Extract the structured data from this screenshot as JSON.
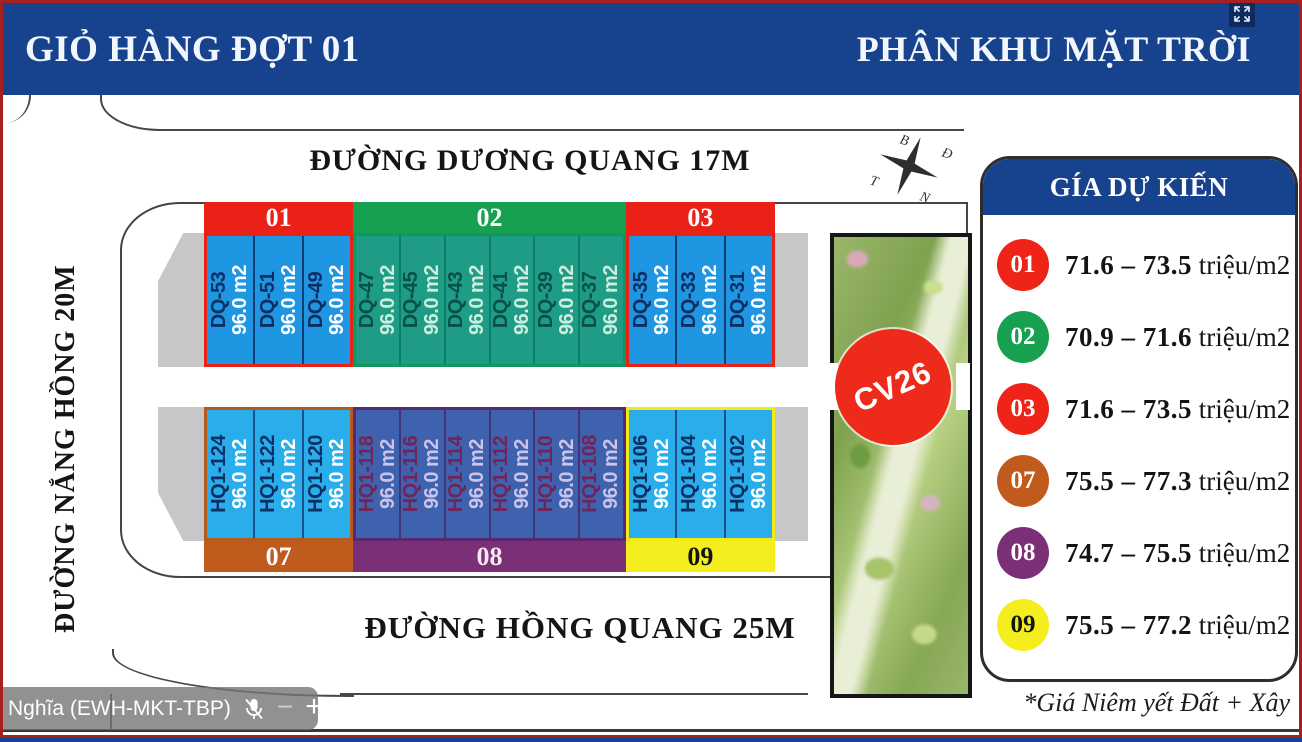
{
  "banner": {
    "left_title": "GIỎ HÀNG ĐỢT 01",
    "right_title": "PHÂN KHU MẶT TRỜI",
    "bg_color": "#17428e"
  },
  "streets": {
    "top": "ĐƯỜNG DƯƠNG QUANG 17M",
    "left": "ĐƯỜNG NẮNG HỒNG 20M",
    "bottom": "ĐƯỜNG HỒNG QUANG 25M"
  },
  "compass": {
    "north": "B",
    "east": "Đ",
    "south": "N",
    "west": "T"
  },
  "park": {
    "label": "CV26",
    "circle_color": "#ee2a1b"
  },
  "area_label": "96.0 m2",
  "blocks": [
    {
      "id": "01",
      "row": "top",
      "header_bg": "#e92117",
      "header_text": "#ffffff",
      "border": "#e92117",
      "plot_bg": "#1e96e2",
      "divider": "#123c74",
      "name_color": "#0d2f63",
      "area_color": "#ffffff",
      "plots": [
        "DQ-53",
        "DQ-51",
        "DQ-49"
      ]
    },
    {
      "id": "02",
      "row": "top",
      "header_bg": "#16a04f",
      "header_text": "#ffffff",
      "border": "#11975c",
      "plot_bg": "#1f9c85",
      "divider": "#0a7f66",
      "name_color": "#07514a",
      "area_color": "#cdeedd",
      "plots": [
        "DQ-47",
        "DQ-45",
        "DQ-43",
        "DQ-41",
        "DQ-39",
        "DQ-37"
      ]
    },
    {
      "id": "03",
      "row": "top",
      "header_bg": "#e92117",
      "header_text": "#ffffff",
      "border": "#e92117",
      "plot_bg": "#1e96e2",
      "divider": "#123c74",
      "name_color": "#0d2f63",
      "area_color": "#ffffff",
      "plots": [
        "DQ-35",
        "DQ-33",
        "DQ-31"
      ]
    },
    {
      "id": "07",
      "row": "bottom",
      "header_bg": "#c05a1d",
      "header_text": "#ffffff",
      "border": "#b55a1d",
      "plot_bg": "#29aeeb",
      "divider": "#1d4f8c",
      "name_color": "#0d2f63",
      "area_color": "#ffffff",
      "plots": [
        "HQ1-124",
        "HQ1-122",
        "HQ1-120"
      ]
    },
    {
      "id": "08",
      "row": "bottom",
      "header_bg": "#7b2f77",
      "header_text": "#f3e8f5",
      "border": "#5d2670",
      "plot_bg": "#3f62ae",
      "divider": "#443277",
      "name_color": "#702457",
      "area_color": "#cdc3ea",
      "plots": [
        "HQ1-118",
        "HQ1-116",
        "HQ1-114",
        "HQ1-112",
        "HQ1-110",
        "HQ1-108"
      ]
    },
    {
      "id": "09",
      "row": "bottom",
      "header_bg": "#f5ee1e",
      "header_text": "#141414",
      "border": "#f2ea16",
      "plot_bg": "#29aeeb",
      "divider": "#1d4f8c",
      "name_color": "#0d2f63",
      "area_color": "#ffffff",
      "plots": [
        "HQ1-106",
        "HQ1-104",
        "HQ1-102"
      ]
    }
  ],
  "legend": {
    "title": "GÍA DỰ KIẾN",
    "header_bg": "#17428e",
    "rows": [
      {
        "id": "01",
        "color": "#ee2418",
        "label_color": "#ffffff",
        "range": "71.6 – 73.5",
        "unit": "triệu/m2"
      },
      {
        "id": "02",
        "color": "#16a04f",
        "label_color": "#ffffff",
        "range": "70.9 – 71.6",
        "unit": "triệu/m2"
      },
      {
        "id": "03",
        "color": "#ee2418",
        "label_color": "#ffffff",
        "range": "71.6 – 73.5",
        "unit": "triệu/m2"
      },
      {
        "id": "07",
        "color": "#c05a1d",
        "label_color": "#ffffff",
        "range": "75.5 – 77.3",
        "unit": "triệu/m2"
      },
      {
        "id": "08",
        "color": "#7b2f77",
        "label_color": "#ffffff",
        "range": "74.7 – 75.5",
        "unit": "triệu/m2"
      },
      {
        "id": "09",
        "color": "#f5ee1e",
        "label_color": "#141414",
        "range": "75.5 – 77.2",
        "unit": "triệu/m2"
      }
    ],
    "note": "*Giá Niêm yết Đất + Xây"
  },
  "overlay": {
    "name": "Nghĩa (EWH-MKT-TBP)",
    "minus": "−",
    "plus": "+"
  }
}
